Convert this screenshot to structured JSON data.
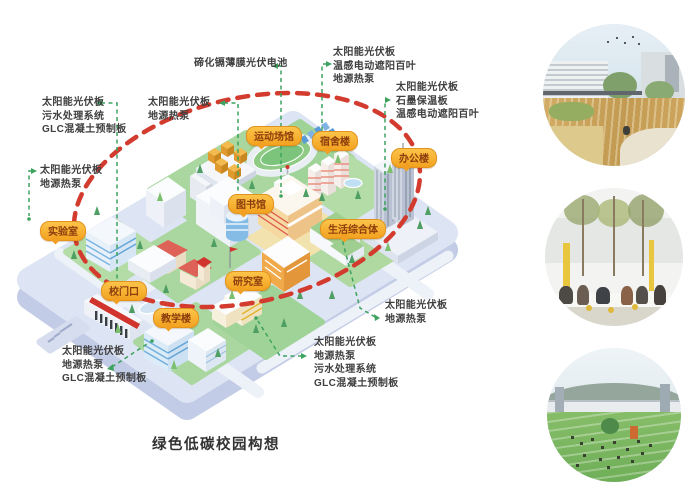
{
  "title": "绿色低碳校园构想",
  "colors": {
    "label_bg": "#f5a82c",
    "label_text": "#8c3d0d",
    "red_boundary": "#d23b2e",
    "green_connector": "#3da35f",
    "platform": "#dde4f3",
    "grass": "#a9d79f"
  },
  "diagram": {
    "building_labels": [
      {
        "label": "实验室"
      },
      {
        "label": "校门口"
      },
      {
        "label": "教学楼"
      },
      {
        "label": "研究室"
      },
      {
        "label": "图书馆"
      },
      {
        "label": "运动场馆"
      },
      {
        "label": "宿舍楼"
      },
      {
        "label": "办公楼"
      },
      {
        "label": "生活综合体"
      }
    ],
    "annotations": [
      {
        "id": "top-center",
        "lines": [
          "碲化镉薄膜光伏电池"
        ]
      },
      {
        "id": "top-right",
        "lines": [
          "太阳能光伏板",
          "温感电动遮阳百叶",
          "地源热泵"
        ]
      },
      {
        "id": "right",
        "lines": [
          "太阳能光伏板",
          "石墨保温板",
          "温感电动遮阳百叶"
        ]
      },
      {
        "id": "left-upper",
        "lines": [
          "太阳能光伏板",
          "污水处理系统",
          "GLC混凝土预制板"
        ]
      },
      {
        "id": "mid-upper",
        "lines": [
          "太阳能光伏板",
          "地源热泵"
        ]
      },
      {
        "id": "left-mid",
        "lines": [
          "太阳能光伏板",
          "地源热泵"
        ]
      },
      {
        "id": "bottom-left",
        "lines": [
          "太阳能光伏板",
          "地源热泵",
          "GLC混凝土预制板"
        ]
      },
      {
        "id": "bottom-center",
        "lines": [
          "太阳能光伏板",
          "地源热泵",
          "污水处理系统",
          "GLC混凝土预制板"
        ]
      },
      {
        "id": "bottom-right",
        "lines": [
          "太阳能光伏板",
          "地源热泵"
        ]
      }
    ]
  }
}
